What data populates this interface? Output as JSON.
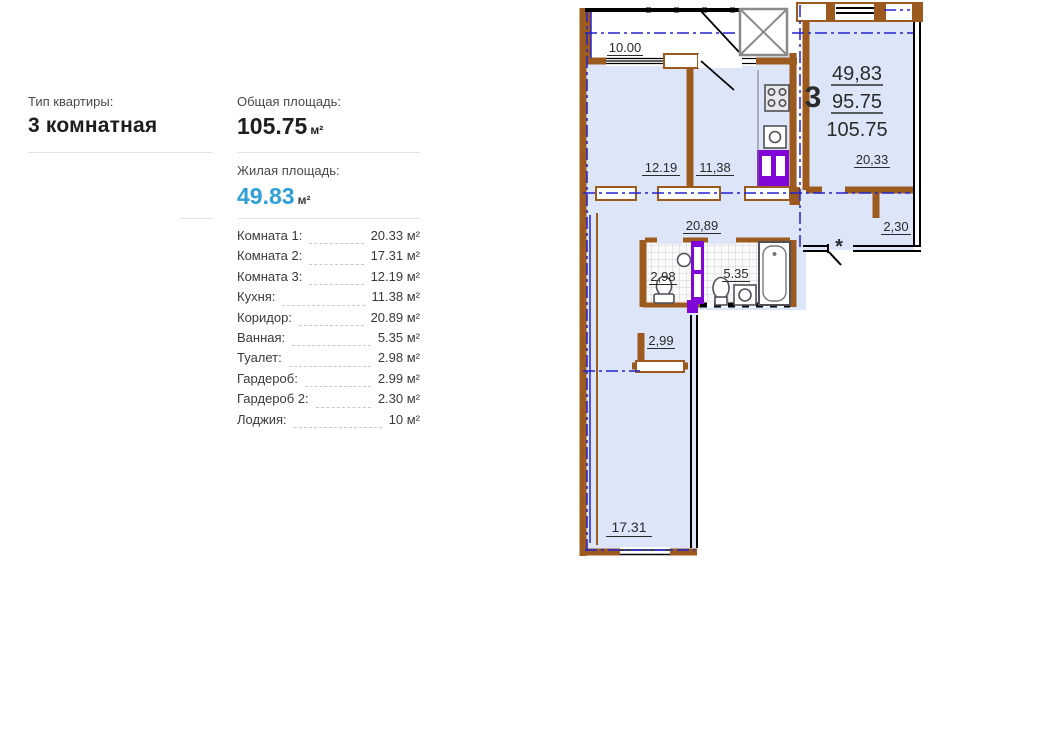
{
  "panel": {
    "type_label": "Тип квартиры:",
    "type_value": "3 комнатная",
    "total_label": "Общая площадь:",
    "total_value": "105.75",
    "total_unit": "м²",
    "living_label": "Жилая площадь:",
    "living_value": "49.83",
    "living_unit": "м²",
    "rooms": [
      {
        "label": "Комната 1:",
        "value": "20.33 м²"
      },
      {
        "label": "Комната 2:",
        "value": "17.31 м²"
      },
      {
        "label": "Комната 3:",
        "value": "12.19 м²"
      },
      {
        "label": "Кухня:",
        "value": "11.38 м²"
      },
      {
        "label": "Коридор:",
        "value": "20.89 м²"
      },
      {
        "label": "Ванная:",
        "value": "5.35 м²"
      },
      {
        "label": "Туалет:",
        "value": "2.98 м²"
      },
      {
        "label": "Гардероб:",
        "value": "2.99 м²"
      },
      {
        "label": "Гардероб 2:",
        "value": "2.30 м²"
      },
      {
        "label": "Лоджия:",
        "value": "10 м²"
      }
    ]
  },
  "plan": {
    "labels": {
      "loggia": "10.00",
      "room3": "12.19",
      "kitchen": "11,38",
      "room1": "20,33",
      "wardrobe2": "2,30",
      "corridor": "20,89",
      "toilet": "2,98",
      "bath": "5.35",
      "wardrobe": "2,99",
      "room2": "17.31",
      "flat_number": "3",
      "living_area": "49,83",
      "heated_area": "95.75",
      "total_area": "105.75",
      "entrance_mark": "*"
    },
    "colors": {
      "wall_brown": "#9c5a1e",
      "room_fill": "#dce6f8",
      "axis_blue": "#2323cf",
      "door_purple": "#7f06d6",
      "mark_red": "#e82222"
    }
  },
  "accent_color": "#2f9fd8"
}
